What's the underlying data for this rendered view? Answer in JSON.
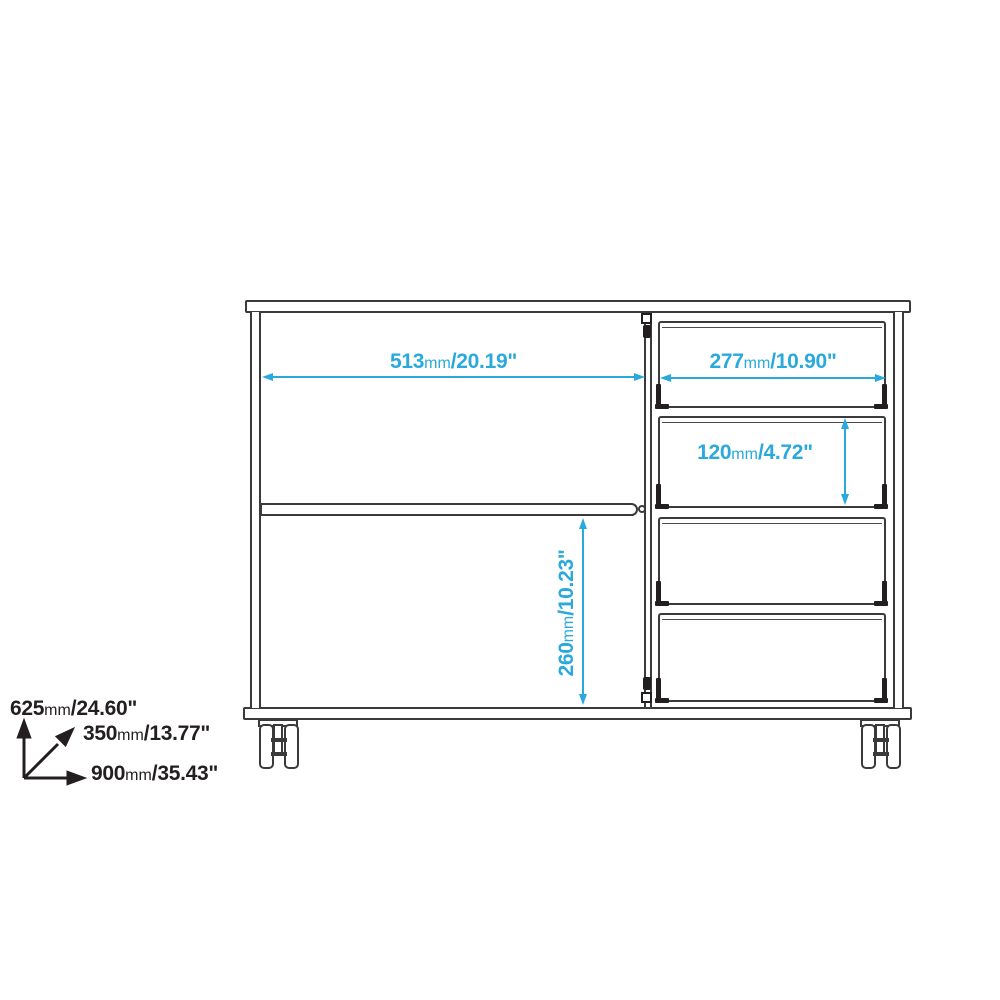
{
  "page": {
    "type": "furniture technical line drawing",
    "background": "#ffffff"
  },
  "colors": {
    "dimension_accent": "#2aa9dc",
    "drawing_line": "#3a3a3a",
    "black_text": "#231f20"
  },
  "dimensions": {
    "left_compartment_width": {
      "mm": "513",
      "unit": "mm",
      "inches": "/20.19\""
    },
    "drawer_width": {
      "mm": "277",
      "unit": "mm",
      "inches": "/10.90\""
    },
    "drawer_height": {
      "mm": "120",
      "unit": "mm",
      "inches": "/4.72\""
    },
    "lower_compartment_height": {
      "mm": "260",
      "unit": "mm",
      "inches": "/10.23\""
    },
    "overall_height": {
      "mm": "625",
      "unit": "mm",
      "inches": "/24.60\""
    },
    "overall_depth": {
      "mm": "350",
      "unit": "mm",
      "inches": "/13.77\""
    },
    "overall_width": {
      "mm": "900",
      "unit": "mm",
      "inches": "/35.43\""
    }
  }
}
